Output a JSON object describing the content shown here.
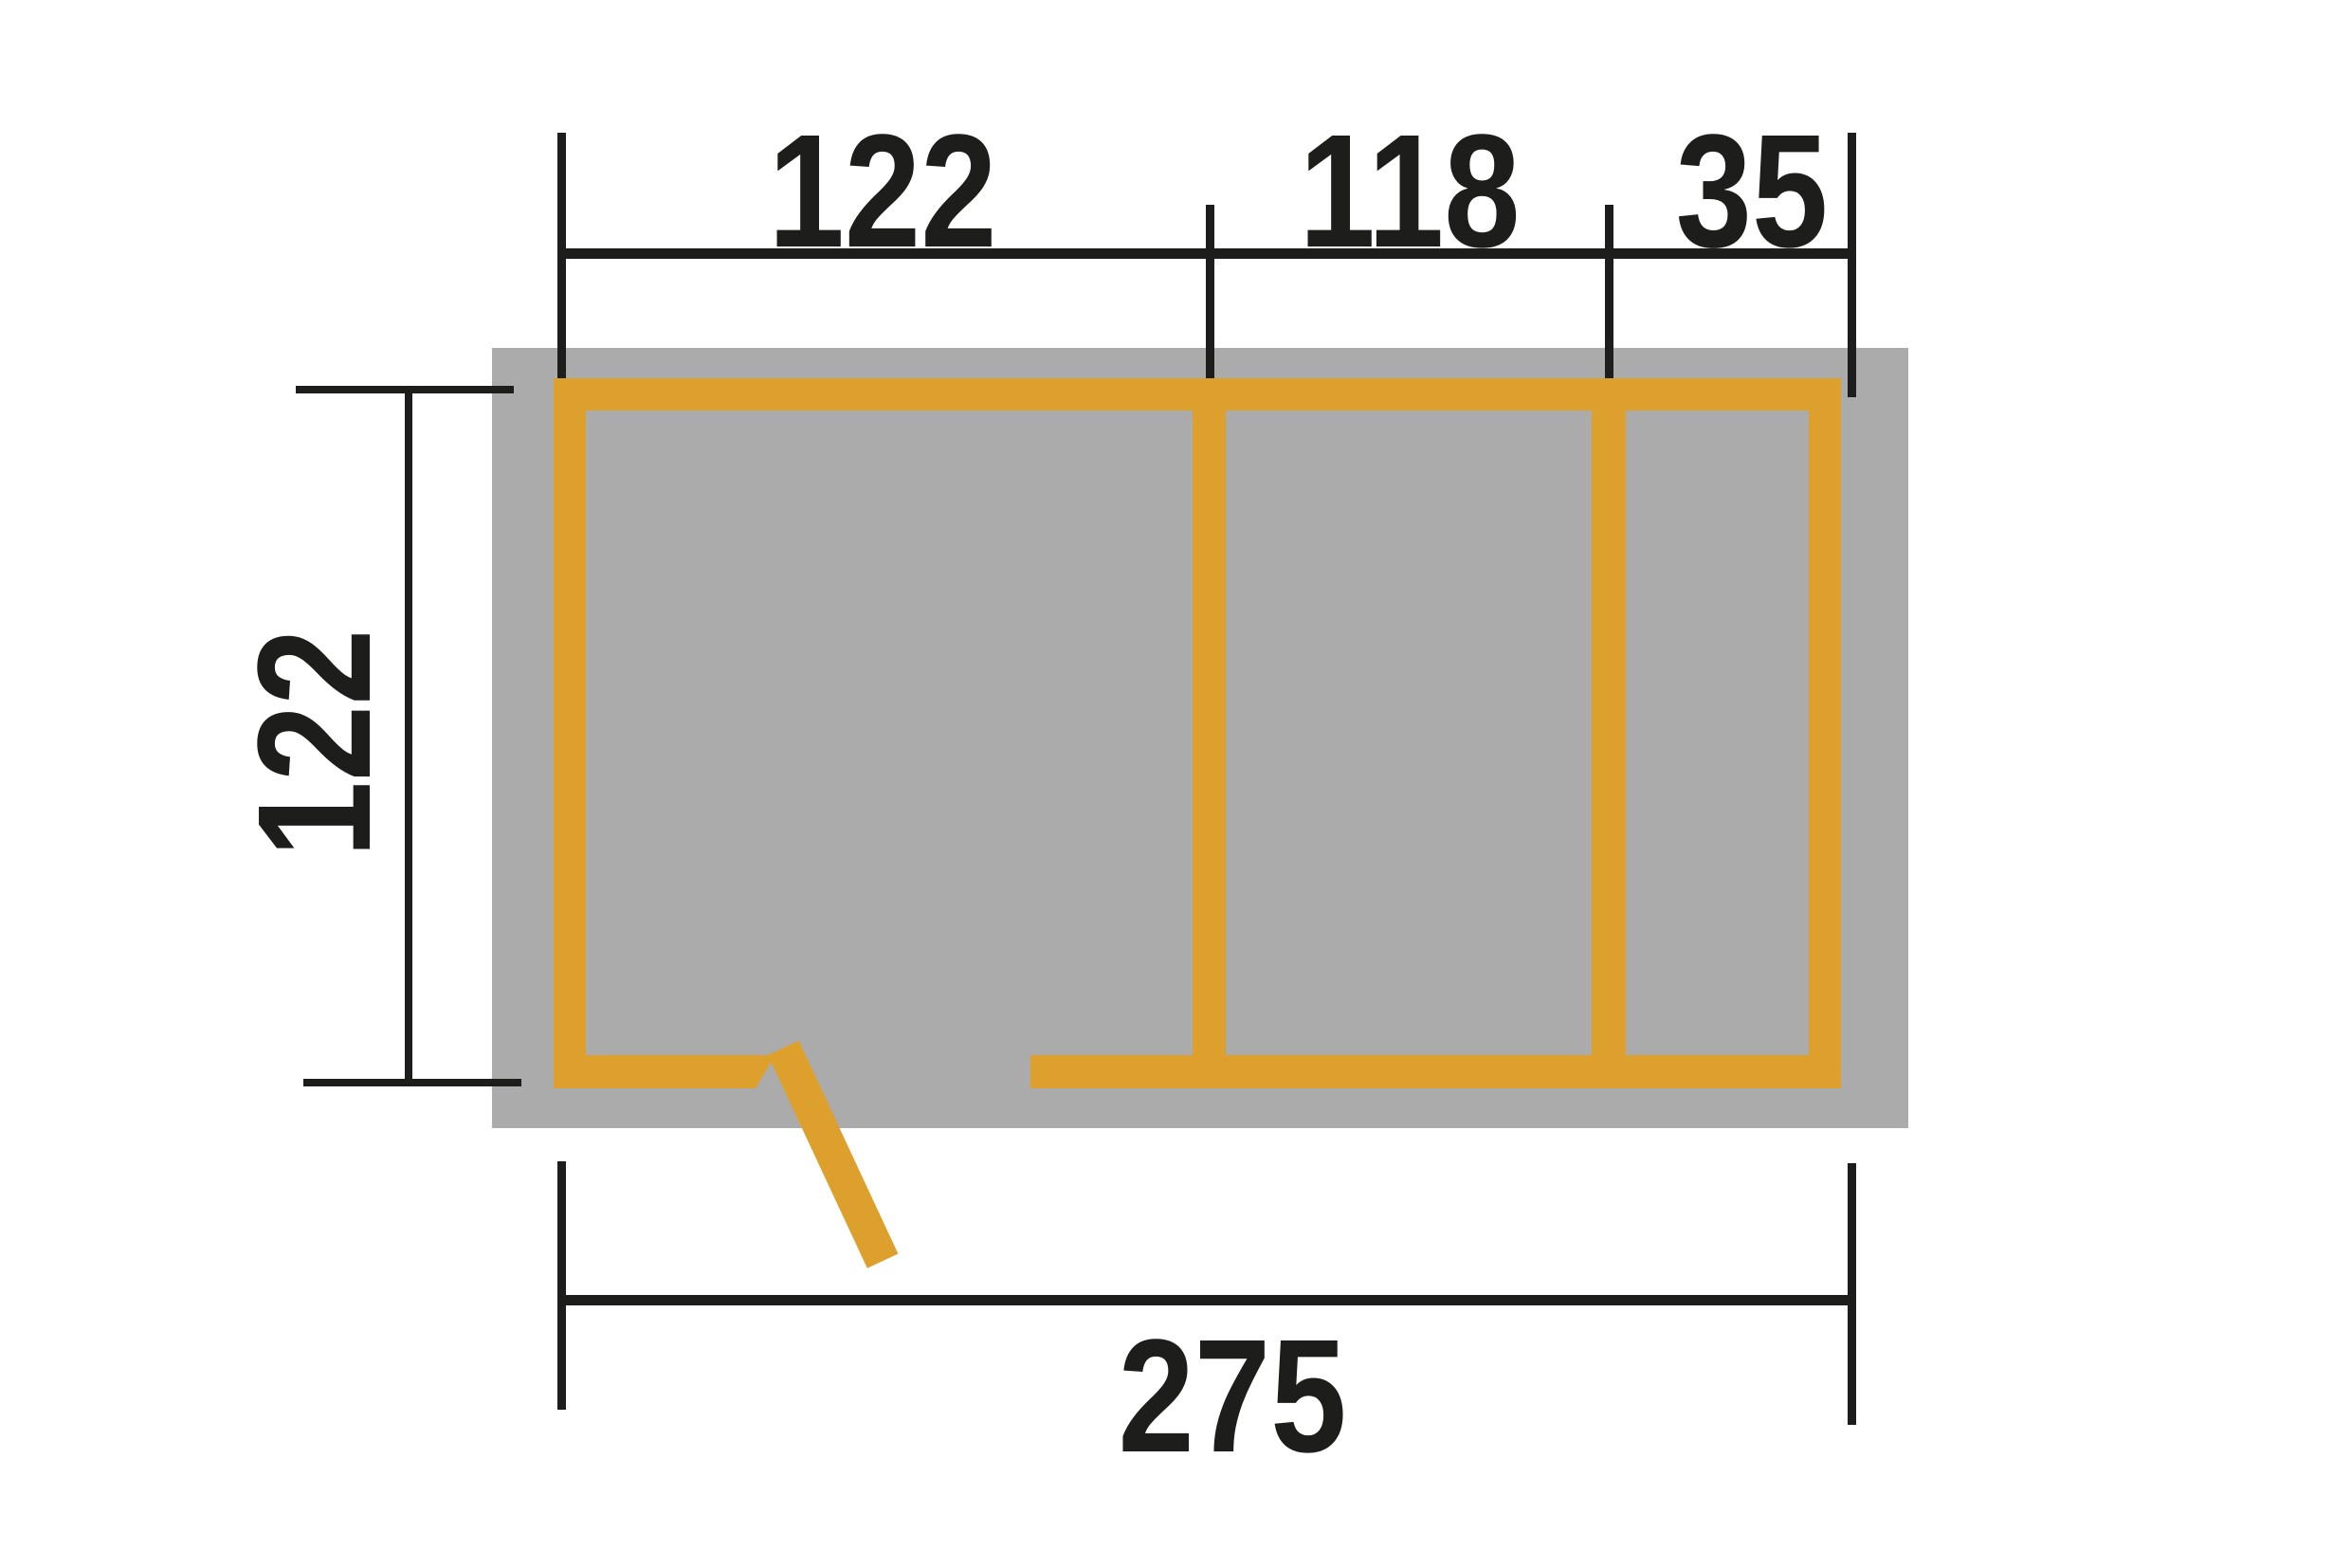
{
  "diagram": {
    "type": "floor-plan-top-view",
    "dimensions": {
      "top_segments": [
        "122",
        "118",
        "35"
      ],
      "left_height": "122",
      "bottom_total": "275"
    },
    "colors": {
      "wall": "#DEA02C",
      "base": "#ABABAB",
      "line": "#1D1D1B",
      "background": "#FFFFFF"
    }
  }
}
